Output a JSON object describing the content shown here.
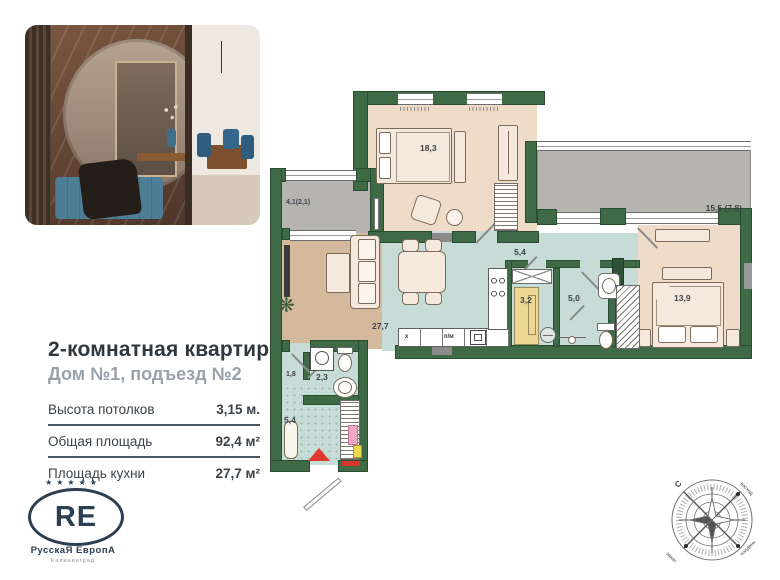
{
  "listing": {
    "title": "2-комнатная квартира",
    "subtitle": "Дом №1, подъезд №2",
    "specs": [
      {
        "label": "Высота потолков",
        "value": "3,15 м."
      },
      {
        "label": "Общая площадь",
        "value": "92,4 м²"
      },
      {
        "label": "Площадь кухни",
        "value": "27,7 м²"
      }
    ]
  },
  "brand": {
    "stars": "★★★★★",
    "initials": "RE",
    "name": "РусскаЯ ЕвропА",
    "city": "Калининград"
  },
  "floorplan": {
    "rooms": {
      "bedroom1": "18,3",
      "balcony1": "4,1(2,1)",
      "balcony2": "15,5 (7,8)",
      "hall": "5,4",
      "living_kitchen": "27,7",
      "bath1": "3,2",
      "wc": "5,0",
      "bedroom2": "13,9",
      "corridor": "1,8",
      "bath2": "2,3",
      "entry_hall": "5,4"
    },
    "appliances": {
      "fridge": "х",
      "dishwasher": "п/м"
    }
  },
  "compass": {
    "north": "С",
    "sunrise": "восход",
    "sunset": "закат",
    "noon": "полдень"
  },
  "colors": {
    "wall": "#3e6a45",
    "floor_warm": "#eedcc9",
    "floor_living": "#d5b99c",
    "floor_wet": "#c7dcd7",
    "balcony": "#b6b4b0",
    "accent_red": "#e0392c",
    "brand_navy": "#2c3e52"
  }
}
